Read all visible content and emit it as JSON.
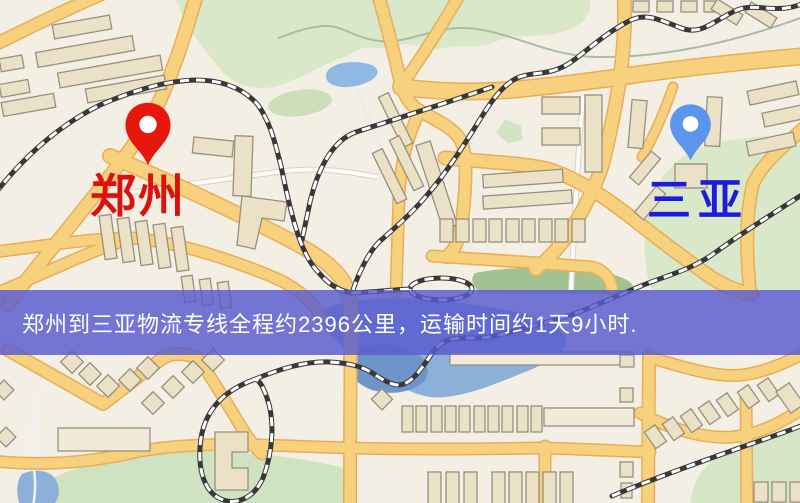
{
  "map": {
    "origin": {
      "label": "郑州",
      "pin_color": "#e8170e",
      "label_color": "#dd100b"
    },
    "destination": {
      "label": "三亚",
      "pin_color": "#5b95ec",
      "label_color": "#1d1cdc"
    },
    "banner": {
      "text": "郑州到三亚物流专线全程约2396公里，运输时间约1天9小时.",
      "background_color": "#585ace",
      "text_color": "#ffffff",
      "route": {
        "from": "郑州",
        "to": "三亚",
        "distance_km": "2396",
        "duration": "1天9小时"
      }
    },
    "legend_colors": {
      "land": "#f4efe5",
      "road_fill": "#f7d17d",
      "road_casing": "#e9ad58",
      "water": "#8cb0d8",
      "park": "#cfe3c0",
      "railway": "#383838",
      "building": "#ebe1c6"
    }
  }
}
